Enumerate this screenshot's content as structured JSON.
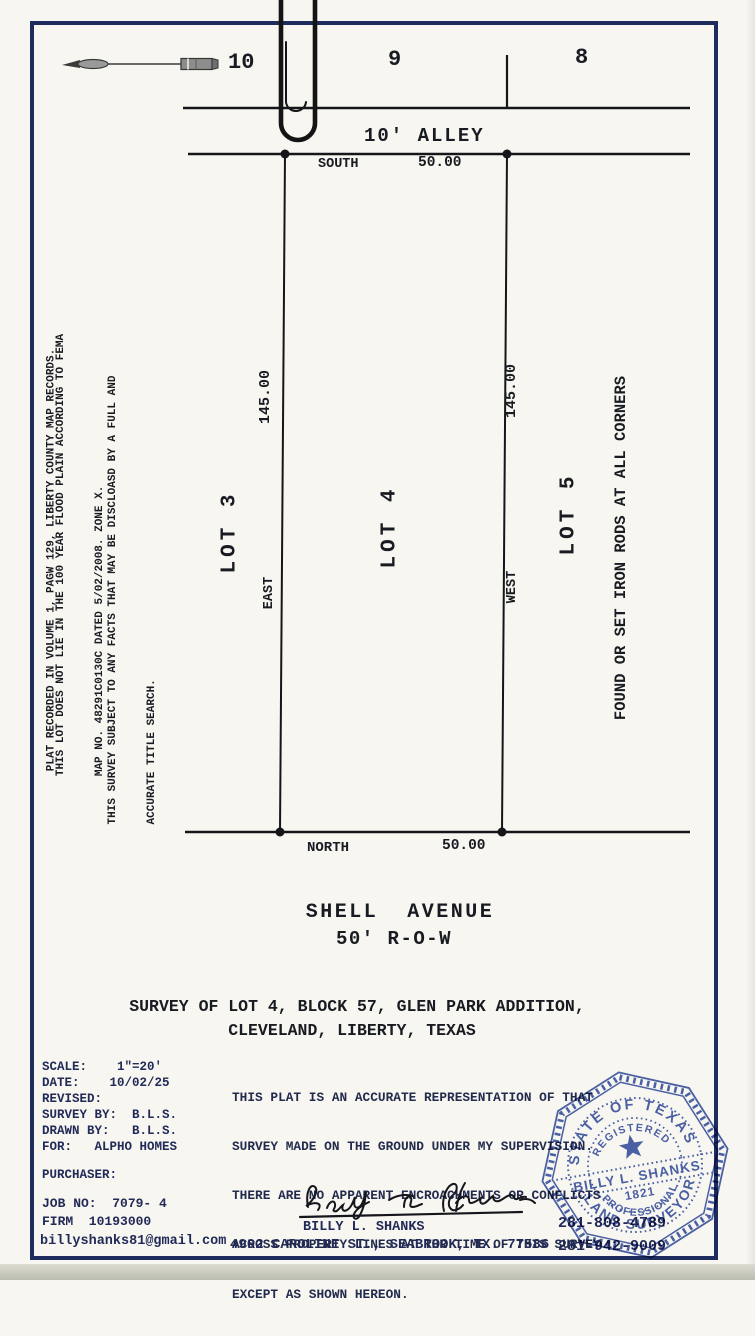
{
  "colors": {
    "border_navy": "#1f2c5e",
    "stamp_blue": "#3d55a5",
    "ink": "#191b22",
    "typed_navy": "#222a57"
  },
  "icons": {
    "north_arrow": "north-arrow-icon",
    "paperclip": "paperclip-icon",
    "corner_marker": "iron-rod-corner-dot"
  },
  "block_row": {
    "lot_10": "10",
    "lot_9": "9",
    "lot_8": "8"
  },
  "alley": {
    "label": "10' ALLEY",
    "south_bearing": "SOUTH",
    "south_distance": "50.00"
  },
  "plat": {
    "lot3": "LOT 3",
    "lot4": "LOT 4",
    "lot5": "LOT 5",
    "west_dim": "145.00",
    "east_dim": "145.00",
    "east_bearing": "EAST",
    "west_bearing": "WEST",
    "north_bearing": "NORTH",
    "north_distance": "50.00",
    "iron_rods_note": "FOUND OR SET IRON RODS AT ALL CORNERS"
  },
  "notes": {
    "note1": "PLAT RECORDED IN VOLUME 1, PAGW 129, LIBERTY COUNTY MAP RECORDS.",
    "note2_line1": "THIS LOT DOES NOT LIE IN THE 100 YEAR FLOOD PLAIN ACCORDING TO FEMA",
    "note2_line2": "MAP NO. 48291C0130C DATED 5/02/2008. ZONE X.",
    "note3_line1": "THIS SURVEY SUBJECT TO ANY FACTS THAT MAY BE DISCLOASD BY A FULL AND",
    "note3_line2": "ACCURATE TITLE SEARCH."
  },
  "street": {
    "name": "SHELL  AVENUE",
    "row": "50' R-O-W"
  },
  "title": {
    "line1": "SURVEY OF LOT 4, BLOCK 57, GLEN PARK ADDITION,",
    "line2": "CLEVELAND, LIBERTY, TEXAS"
  },
  "info": {
    "scale": "SCALE:    1\"=20'",
    "date": "DATE:    10/02/25",
    "revised": "REVISED:",
    "survey_by": "SURVEY BY:  B.L.S.",
    "drawn_by": "DRAWN BY:   B.L.S.",
    "for": "FOR:   ALPHO HOMES",
    "purchaser": "PURCHASER:",
    "job_no": "JOB NO:  7079- 4",
    "firm": "FIRM  10193000",
    "email": "billyshanks81@gmail.com"
  },
  "certification": {
    "line1": "THIS PLAT IS AN ACCURATE REPRESENTATION OF THAT",
    "line2": "SURVEY MADE ON THE GROUND UNDER MY SUPERVISION.",
    "line3": "THERE ARE NO APPARENT ENCROACHMENTS OR CONFLICTS",
    "line4": "ACROSS PROPERTY LINES AT THR TIME OF THIS SURVEY",
    "line5": "EXCEPT AS SHOWN HEREON."
  },
  "stamp": {
    "arc_top": "STATE OF TEXAS",
    "arc_registered": "REGISTERED",
    "name": "BILLY L. SHANKS",
    "number": "1821",
    "arc_professional": "PROFESSIONAL",
    "arc_bottom": "LAND SURVEYOR"
  },
  "footer": {
    "surveyor_name": "BILLY L. SHANKS",
    "address": "4902 CAROLINE ST., SEABROOK, TX. 77586",
    "phone1": "281-808-4789",
    "phone2": "281-942-9009"
  }
}
